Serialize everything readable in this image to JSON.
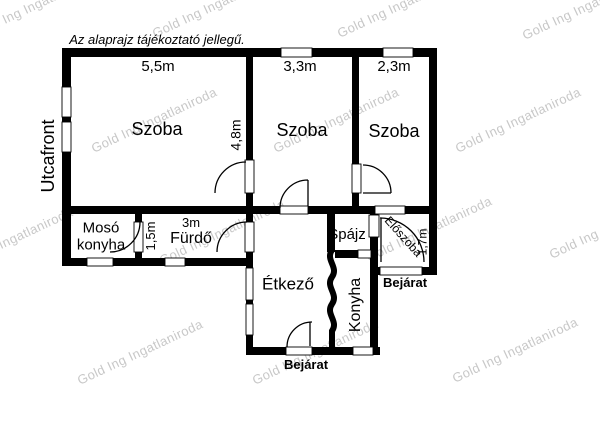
{
  "disclaimer": "Az alaprajz tájékoztató jellegű.",
  "watermark": {
    "text": "Gold Ing Ingatlaniroda"
  },
  "outside": {
    "street_front": "Utcafront",
    "entrance_main": "Bejárat",
    "entrance_side": "Bejárat"
  },
  "rooms": {
    "szoba1": {
      "name": "Szoba",
      "width_m": "5,5m",
      "depth_m": "4,8m"
    },
    "szoba2": {
      "name": "Szoba",
      "width_m": "3,3m"
    },
    "szoba3": {
      "name": "Szoba",
      "width_m": "2,3m"
    },
    "moso_konyha": {
      "line1": "Mosó",
      "line2": "konyha"
    },
    "furdo": {
      "name": "Fürdő",
      "width_m": "3m",
      "depth_m": "1,5m"
    },
    "etkezo": {
      "name": "Étkező"
    },
    "konyha": {
      "name": "Konyha"
    },
    "spajz": {
      "name": "Spájz"
    },
    "eloszoba": {
      "name": "Előszoba",
      "width_m": "1,7m"
    }
  },
  "colors": {
    "wall": "#000000",
    "background": "#ffffff",
    "watermark": "#c8c8c8"
  }
}
